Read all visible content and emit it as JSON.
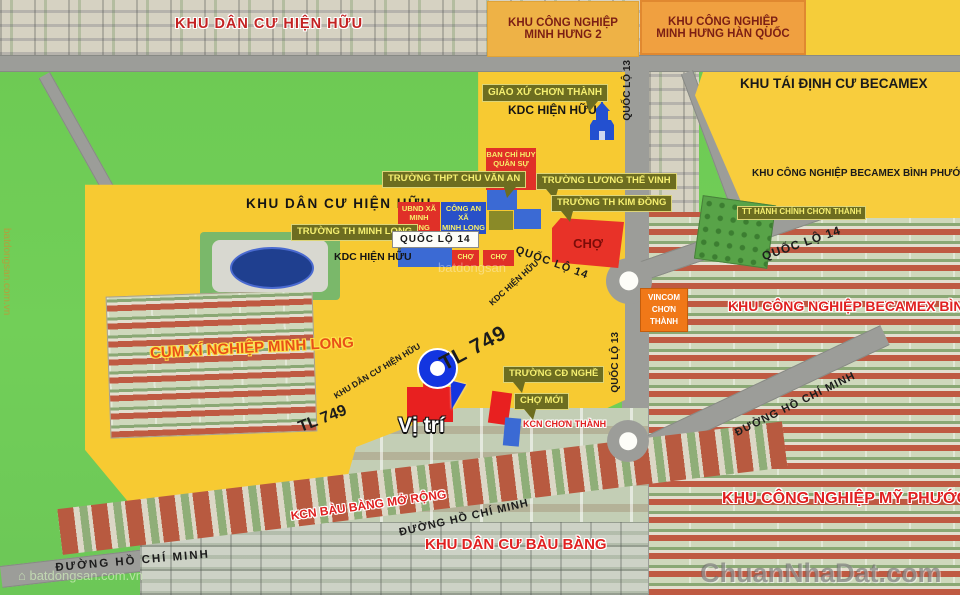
{
  "labels": {
    "kdc_hien_huu_top": "KHU DÂN CƯ HIỆN HỮU",
    "kcn_minh_hung_2": "KHU CÔNG NGHIỆP\nMINH HƯNG 2",
    "kcn_minh_hung_han_quoc": "KHU CÔNG NGHIỆP\nMINH HƯNG HÀN QUỐC",
    "khu_tai_dinh_cu_becamex": "KHU TÁI ĐỊNH CƯ\nBECAMEX",
    "kcn_becamex_binh_phuoc_small": "KHU CÔNG NGHIỆP\nBECAMEX BÌNH PHƯỚC",
    "kcn_becamex_binh_phuoc_big": "KHU CÔNG NGHIỆP\nBECAMEX BÌNH PHƯỚC",
    "giao_xu_chon_thanh": "GIÁO XỨ CHƠN THÀNH",
    "kdc_hien_huu_1": "KDC HIỆN HỮU",
    "ban_chi_huy": "BAN CHỈ HUY\nQUÂN SỰ\nCHƠN THÀNH",
    "truong_thpt_chu_van_an": "TRƯỜNG THPT CHU VĂN AN",
    "truong_luong_the_vinh": "TRƯỜNG LƯƠNG THẾ VINH",
    "truong_th_kim_dong": "TRƯỜNG TH KIM ĐỒNG",
    "ubnd_xa_minh_long": "UBND XÃ\nMINH LONG",
    "cong_an_xa_minh_long": "CÔNG AN XÃ\nMINH LONG",
    "truong_th_minh_long": "TRƯỜNG TH MINH LONG",
    "khu_dan_cu_hien_huu": "KHU DÂN CƯ HIỆN HỮU",
    "kdc_hien_huu_2": "KDC HIỆN HỮU",
    "kdc_hien_huu_road": "KDC HIỆN HỮU",
    "khu_dan_cu_hien_huu_road": "KHU DÂN CƯ HIỆN HỮU",
    "cho_zone": "CHỢ",
    "cho_1": "CHỢ",
    "cho_2": "CHỢ",
    "vincom": "VINCOM\nCHƠN\nTHÀNH",
    "tt_hanh_chinh": "TT HÀNH CHÍNH CHƠN THÀNH",
    "cum_xi_nghiep_minh_long": "CỤM XÍ NGHIỆP\nMINH LONG",
    "vi_tri": "Vị trí",
    "truong_cd_nghe": "TRƯỜNG CĐ NGHỀ",
    "cho_moi": "CHỢ MỚI",
    "kcn_chon_thanh": "KCN\nCHƠN THÀNH",
    "kcn_my_phuoc_5": "KHU CÔNG NGHIỆP\nMỸ PHƯỚC 5",
    "khu_dan_cu_bau_bang": "KHU DÂN CƯ BÀU BÀNG",
    "kcn_bau_bang_mo_rong": "KCN BÀU BÀNG MỞ RỘNG"
  },
  "roads": {
    "ql13_a": "QUỐC LỘ 13",
    "ql13_b": "QUỐC LỘ 13",
    "ql14_box": "QUỐC LỘ 14",
    "ql14_diag": "QUỐC LỘ 14",
    "ql14_ne": "QUỐC LỘ 14",
    "tl749_a": "TL 749",
    "tl749_b": "TL 749",
    "dhcm_a": "ĐƯỜNG HỒ CHÍ MINH",
    "dhcm_b": "ĐƯỜNG HỒ CHÍ MINH",
    "dhcm_c": "ĐƯỜNG HỒ CHÍ MINH"
  },
  "watermarks": {
    "main": "ChuanNhaDat.com",
    "left_vertical": "batdongsan.com.vn",
    "bottom_left": "batdongsan.com.vn",
    "center": "batdongsan"
  },
  "colors": {
    "land_green": "#6ecd57",
    "parcel_yellow": "#f7ca32",
    "road_gray": "#9c9d99",
    "label_olive": "#6d6d20",
    "label_red": "#e03028",
    "label_blue": "#2850c8",
    "vincom_orange": "#f07818",
    "pin_blue": "#1335e0",
    "marker_red": "#e82020"
  }
}
